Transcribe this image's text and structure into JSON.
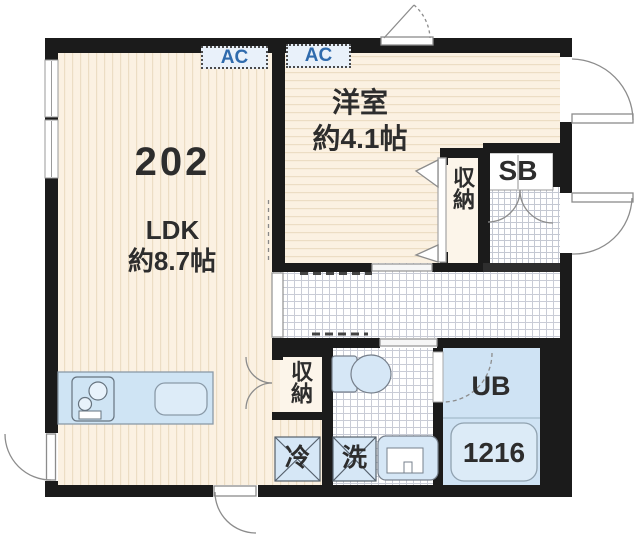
{
  "plan": {
    "unit_number": "202",
    "ldk": {
      "label": "LDK",
      "size": "約8.7帖"
    },
    "bedroom": {
      "label": "洋室",
      "size": "約4.1帖"
    },
    "bedroom_closet_label": "収納",
    "hall_closet_label": "収納",
    "shoe_box_label": "SB",
    "unit_bath_label": "UB",
    "bathtub_label": "1216",
    "refrigerator_label": "冷",
    "washer_label": "洗",
    "ac_ldk_label": "AC",
    "ac_bedroom_label": "AC"
  },
  "colors": {
    "wall": "#1b1b1b",
    "floor_cream": "#fbf1e2",
    "floor_stripe": "#ecddc4",
    "tile_line": "#c9ccd6",
    "fixture_blue": "#d6e7f6",
    "counter_blue": "#cfe4f4",
    "ac_text_blue": "#2f6bad",
    "text_dark": "#2d2d2d"
  }
}
